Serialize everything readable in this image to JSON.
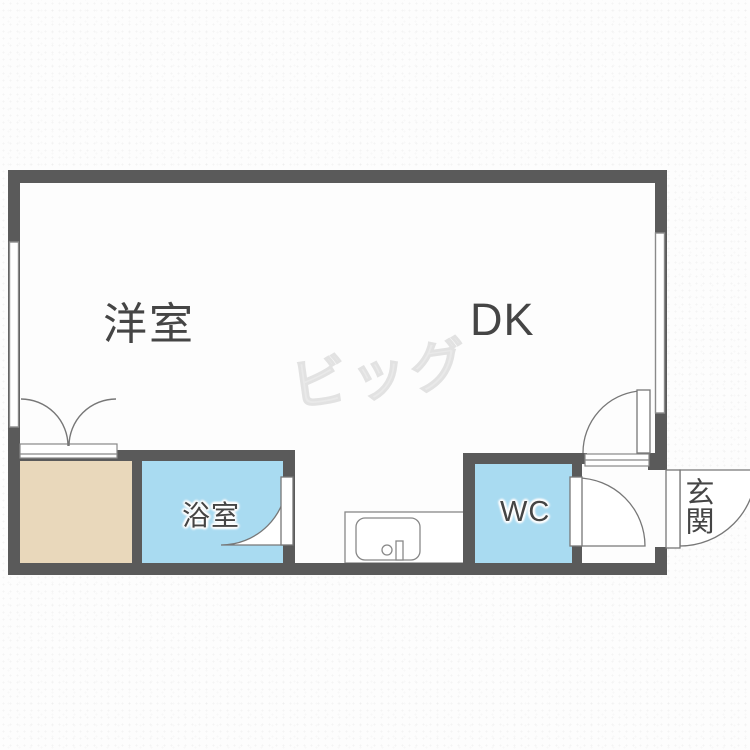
{
  "plan": {
    "title": "apartment-floor-plan",
    "watermark_text": "ビッグ",
    "rooms": {
      "western": {
        "label": "洋室"
      },
      "dining_kitchen": {
        "label": "DK"
      },
      "bathroom": {
        "label": "浴室"
      },
      "toilet": {
        "label": "WC"
      },
      "entrance": {
        "label": "玄関"
      }
    },
    "colors": {
      "wall": "#5a5a5a",
      "water_rooms": "#a9dbf1",
      "closet_floor": "#e9d8bb",
      "floor": "#ffffff",
      "fixture_line": "#777777",
      "label_text": "#454545",
      "watermark": "#e9e9e9"
    }
  }
}
